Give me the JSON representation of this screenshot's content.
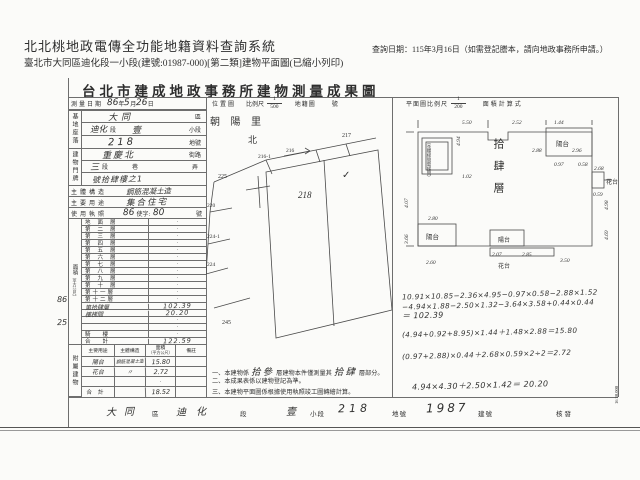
{
  "page": {
    "system_title": "北北桃地政電傳全功能地籍資料查詢系統",
    "query_date": "查詢日期：115年3月16日（如需登記謄本，請向地政事務所申請。）",
    "subtitle": "臺北市大同區迪化段一小段(建號:01987-000)[第二類]建物平面圖(已縮小列印)",
    "print_code": "16 30,000",
    "margin_note_1": "86",
    "margin_note_2": "25"
  },
  "form": {
    "title": "台北市建成地政事務所建物測量成果圖",
    "head": {
      "survey_label": "測量日期",
      "survey_year": "86",
      "unit_year": "年",
      "survey_month": "5",
      "unit_month": "月",
      "survey_day": "26",
      "unit_day": "日",
      "loc_label": "位置圖",
      "scale_label": "比例尺",
      "loc_num": "1",
      "loc_den": "500",
      "cad_label": "地籍圖",
      "sheet_label": "號",
      "plan_scale_label": "平面圖比例尺",
      "plan_num": "1",
      "plan_den": "200",
      "calc_label": "面積計算式"
    },
    "site": {
      "group": "基地座落",
      "r1v": "大同",
      "r1s": "區",
      "r2v": "迪化",
      "r2s": "段",
      "r2v2": "壹",
      "r2s2": "小段",
      "r3v": "218",
      "r3s": "地號"
    },
    "door": {
      "group": "建物門牌",
      "r1v": "重慶北",
      "r1s": "街路",
      "r2v": "三",
      "r2s": "段",
      "r2s2": "巷",
      "r2s3": "弄",
      "r3v": "號拾肆樓之1"
    },
    "structure": {
      "label": "主體構造",
      "value": "鋼筋混凝土造"
    },
    "usage": {
      "label": "主要用途",
      "value": "集合住宅"
    },
    "license": {
      "label": "使用執照",
      "year": "86",
      "mid": "使字:",
      "no": "80",
      "suffix": "號"
    },
    "area": {
      "group1": "面積",
      "group2": "（平方公尺）",
      "floors": [
        {
          "label": "地面層",
          "value": "·"
        },
        {
          "label": "第二層",
          "value": "·"
        },
        {
          "label": "第三層",
          "value": "·"
        },
        {
          "label": "第四層",
          "value": "·"
        },
        {
          "label": "第五層",
          "value": "·"
        },
        {
          "label": "第六層",
          "value": "·"
        },
        {
          "label": "第七層",
          "value": "·"
        },
        {
          "label": "第八層",
          "value": "·"
        },
        {
          "label": "第九層",
          "value": "·"
        },
        {
          "label": "第十層",
          "value": "·"
        },
        {
          "label": "第十一層",
          "value": "·"
        },
        {
          "label": "第十二層",
          "value": "·"
        },
        {
          "label": "第拾肆層",
          "value": "102.39"
        },
        {
          "label": "樓梯間",
          "value": "20.20"
        },
        {
          "label": "",
          "value": "·"
        },
        {
          "label": "",
          "value": "·"
        },
        {
          "label": "騎樓",
          "value": "·"
        },
        {
          "label": "合計",
          "value": "122.59"
        }
      ]
    },
    "annex": {
      "group": "附屬建物",
      "col_use": "主要用途",
      "col_struct": "主體構造",
      "col_area1": "面積",
      "col_area2": "（平方公尺）",
      "col_note": "備註",
      "rows": [
        {
          "use": "陽台",
          "struct": "鋼筋混凝土造",
          "area": "15.80",
          "note": ""
        },
        {
          "use": "花台",
          "struct": "〃",
          "area": "2.72",
          "note": ""
        },
        {
          "use": "",
          "struct": "",
          "area": "·",
          "note": ""
        },
        {
          "use": "合計",
          "struct": "",
          "area": "18.52",
          "note": ""
        }
      ]
    },
    "notes": [
      {
        "no": "一、",
        "pre": "本建物係",
        "h1": "拾參",
        "mid": "層建物本件僅測量其",
        "h2": "拾肆",
        "post": "層部分。"
      },
      {
        "no": "二、",
        "pre": "本成果表係以建物登記為準。",
        "h1": "",
        "mid": "",
        "h2": "",
        "post": ""
      },
      {
        "no": "三、",
        "pre": "本建物平面圖係根據使用執照竣工圖轉繪計算。",
        "h1": "",
        "mid": "",
        "h2": "",
        "post": ""
      }
    ],
    "calc": [
      "10.91×10.85−2.36×4.95−0.97×0.58−2.88×1.52",
      "−4.94×1.88−2.50×1.32−3.64×3.58+0.44×0.44",
      "＝ 102.39",
      "(4.94+0.92+8.95)×1.44＋1.48×2.88＝15.80",
      "(0.97+2.88)×0.44＋2.68×0.59×2÷2＝2.72",
      "4.94×4.30＋2.50×1.42＝ 20.20"
    ],
    "footer": {
      "district_value": "大同",
      "district_label": "區",
      "section_value": "迪化",
      "section_label": "段",
      "subsection_value": "壹",
      "subsection_label": "小段",
      "lot_value": "218",
      "lot_label": "地號",
      "building_value": "1987",
      "building_label": "建號",
      "issue_label": "核發"
    }
  },
  "location_map": {
    "village": "朝 陽 里",
    "north": "北",
    "p225": "225",
    "p216a": "216-1",
    "p216": "216",
    "p217": "217",
    "p220": "220",
    "p224a": "224-1",
    "p224": "224",
    "p245": "245",
    "p218": "218",
    "check": "✓"
  },
  "plan": {
    "floor_label": "拾肆層",
    "stair_note": "（含樓梯間電梯間）",
    "balcony_tr": "陽台",
    "flower_r": "花台",
    "balcony_bl": "陽台",
    "balcony_bc": "陽台",
    "flower_b": "花台",
    "dims": [
      "5.50",
      "2.52",
      "1.44",
      "2.96",
      "4.98",
      "0.58",
      "0.97",
      "2.88",
      "2.68",
      "0.59",
      "4.69",
      "4.07",
      "2.80",
      "3.66",
      "2.07",
      "2.85",
      "3.50",
      "2.60",
      "4.94",
      "1.02"
    ]
  }
}
